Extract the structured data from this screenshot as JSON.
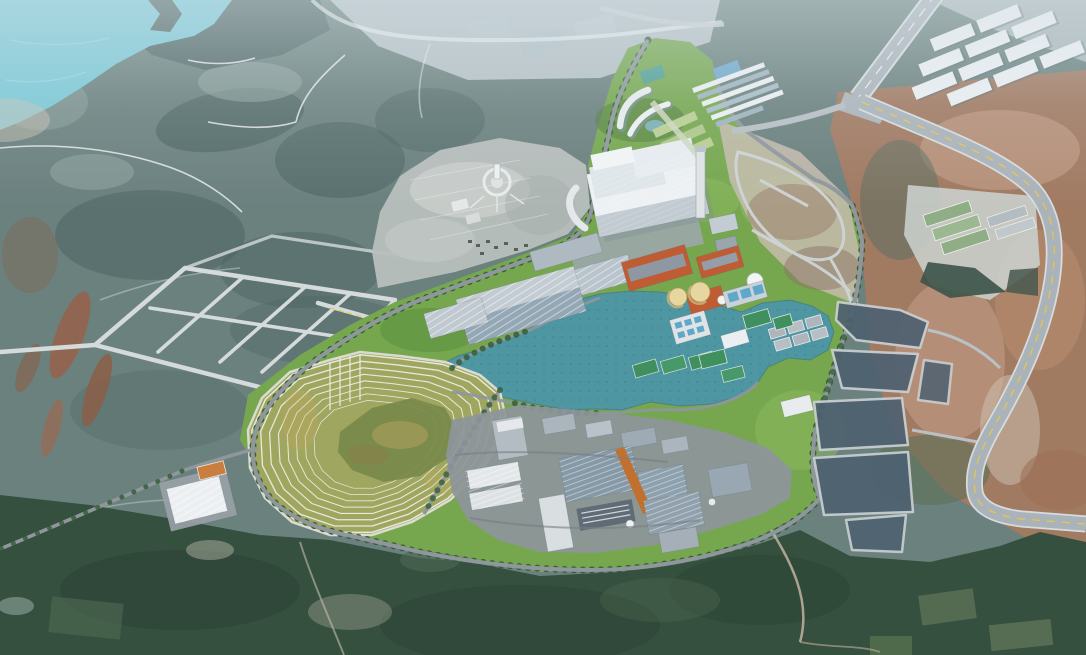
{
  "scene": {
    "type": "aerial-masterplan-rendering",
    "setting": "industrial-park-in-hilly-coastal-terrain",
    "regions": {
      "northwest": "coastal water and dark vegetated hills with farm patches and winding white roads",
      "north_center": "pale flat farmland, ponds, existing village fields with circular monument plaza",
      "northeast": "existing white warehouse district along a diagonal highway interchange",
      "center": "new industrial park with central lake, white warehouses, orange factory blocks, storage tanks, water treatment basins, sports courts",
      "center_north": "large white power-plant building with chimney and campus of curved office buildings",
      "west": "planned road grid over farmland and terraced landscaped hill with concentric rings",
      "east": "graded dark development plots, bare red-brown earth and a curved expressway with yellow median",
      "south": "dense dark-green forest with dirt tracks and a small outpost warehouse with orange court"
    }
  },
  "colors": {
    "sea": "#7bc9d6",
    "terrain": "#6b817e",
    "terrain_dark": "#4b6261",
    "terrain_light": "#93a7a3",
    "flats": "#c2ccd1",
    "village": "#b8bfbd",
    "park": "#76a74f",
    "lawn": "#8cba5f",
    "tree": "#2f5b33",
    "lake": "#4f96a3",
    "lake_dot": "#3f7e8a",
    "terrace": "#9fa65f",
    "terrace_ring": "#e9e9dc",
    "meadow": "#77894a",
    "road": "#8f979d",
    "road_light": "#d5dadb",
    "highway": "#a9b3b9",
    "yellow": "#e5c64b",
    "pavement": "#8d959b",
    "roof_white": "#ebeff1",
    "roof_gray": "#aeb9c2",
    "roof_blue": "#93a7b5",
    "roof_dark": "#63707a",
    "orange": "#bf5c33",
    "conveyor": "#c2702d",
    "tank": "#e6d6a0",
    "pool": "#5fa8c9",
    "court": "#3f8f5f",
    "court_orange": "#c77e3f",
    "glass": "#6fa7c9",
    "earth": "#a67a5f",
    "earth_pink": "#c9a28b",
    "earth_pale": "#cfc4b6",
    "plot": "#4e6170",
    "forest": "#35503f",
    "forest_dark": "#2b4336",
    "forest_light": "#4d6751",
    "shed_green": "#8fae85"
  }
}
